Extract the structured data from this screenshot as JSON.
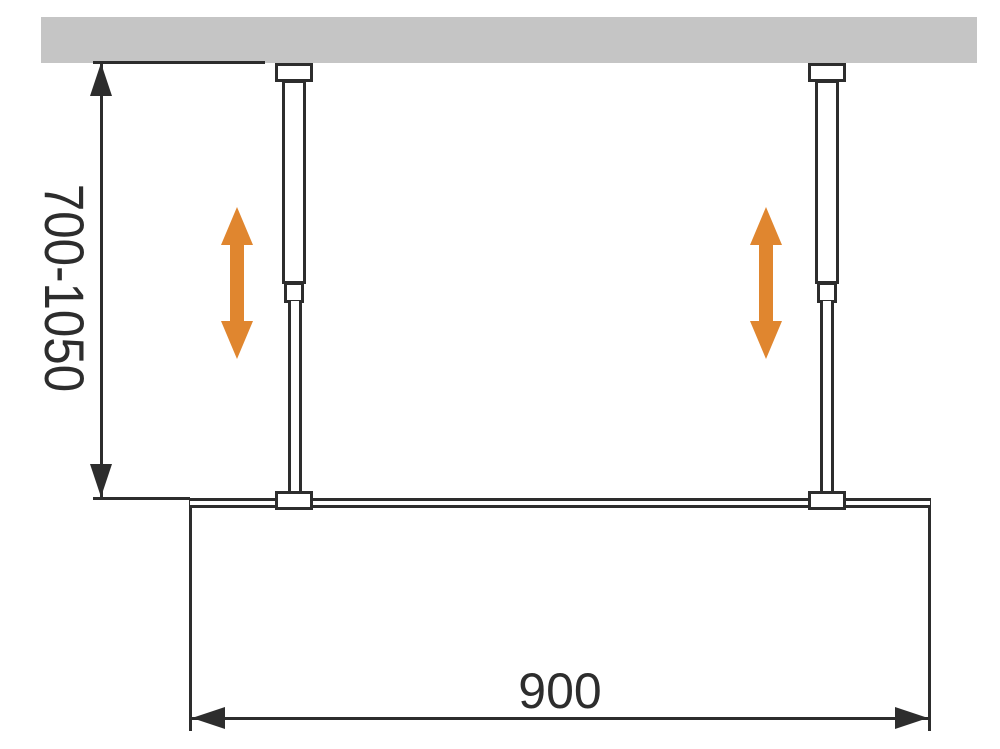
{
  "diagram": {
    "name": "walk-in shower screen ceiling support bar installation drawing",
    "labels": {
      "height_range": "700-1050",
      "width": "900"
    },
    "icons": {
      "left_adjust_arrow": "vertical-double-arrow",
      "right_adjust_arrow": "vertical-double-arrow",
      "height_dim_arrows": "cad-dimension-arrowheads-vertical",
      "width_dim_arrows": "cad-dimension-arrowheads-horizontal"
    },
    "colors": {
      "background": "#ffffff",
      "ceiling": "#c5c5c5",
      "line": "#2d2d2d",
      "accent": "#e0862f"
    }
  }
}
